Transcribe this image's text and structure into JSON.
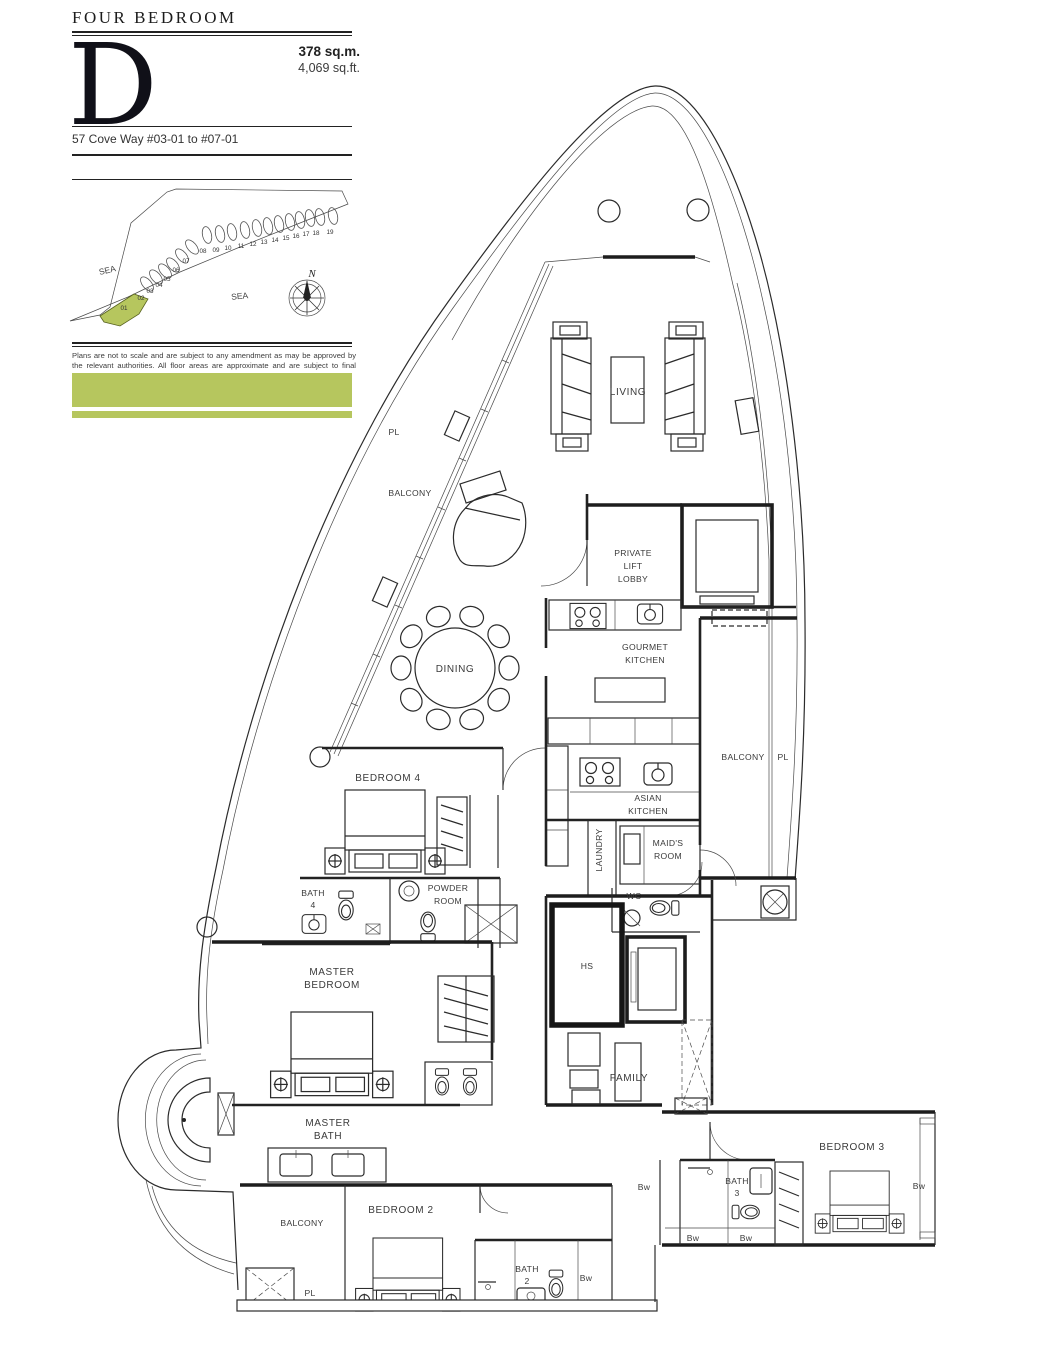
{
  "header": {
    "category": "FOUR BEDROOM",
    "type_letter": "D",
    "area_sqm": "378 sq.m.",
    "area_sqft": "4,069 sq.ft.",
    "address": "57 Cove Way #03-01 to #07-01"
  },
  "site_map": {
    "sea_label": "SEA",
    "north_label": "N",
    "highlighted_unit": "01",
    "highlight_color": "#b6c65e",
    "unit_numbers": [
      "01",
      "02",
      "03",
      "04",
      "05",
      "06",
      "07",
      "08",
      "09",
      "10",
      "11",
      "12",
      "13",
      "14",
      "15",
      "16",
      "17",
      "18",
      "19"
    ]
  },
  "disclaimer": "Plans are not to scale and are subject to any amendment as may be approved by the relevant authorities. All floor areas are approximate and are subject to final survey.",
  "accent_color": "#b6c65e",
  "plan": {
    "rooms": {
      "living": "LIVING",
      "private_lift_lobby": [
        "PRIVATE",
        "LIFT",
        "LOBBY"
      ],
      "gourmet_kitchen": [
        "GOURMET",
        "KITCHEN"
      ],
      "dining": "DINING",
      "asian_kitchen": [
        "ASIAN",
        "KITCHEN"
      ],
      "laundry": "LAUNDRY",
      "maids_room": [
        "MAID'S",
        "ROOM"
      ],
      "bedroom4": "BEDROOM 4",
      "bath4": [
        "BATH",
        "4"
      ],
      "powder_room": [
        "POWDER",
        "ROOM"
      ],
      "wc": "WC",
      "hs": "HS",
      "master_bedroom": [
        "MASTER",
        "BEDROOM"
      ],
      "master_bath": [
        "MASTER",
        "BATH"
      ],
      "family": "FAMILY",
      "bedroom3": "BEDROOM 3",
      "bath3": [
        "BATH",
        "3"
      ],
      "bedroom2": "BEDROOM 2",
      "bath2": [
        "BATH",
        "2"
      ]
    },
    "annotations": {
      "balcony": "BALCONY",
      "pl": "PL",
      "bw": "Bw"
    }
  }
}
